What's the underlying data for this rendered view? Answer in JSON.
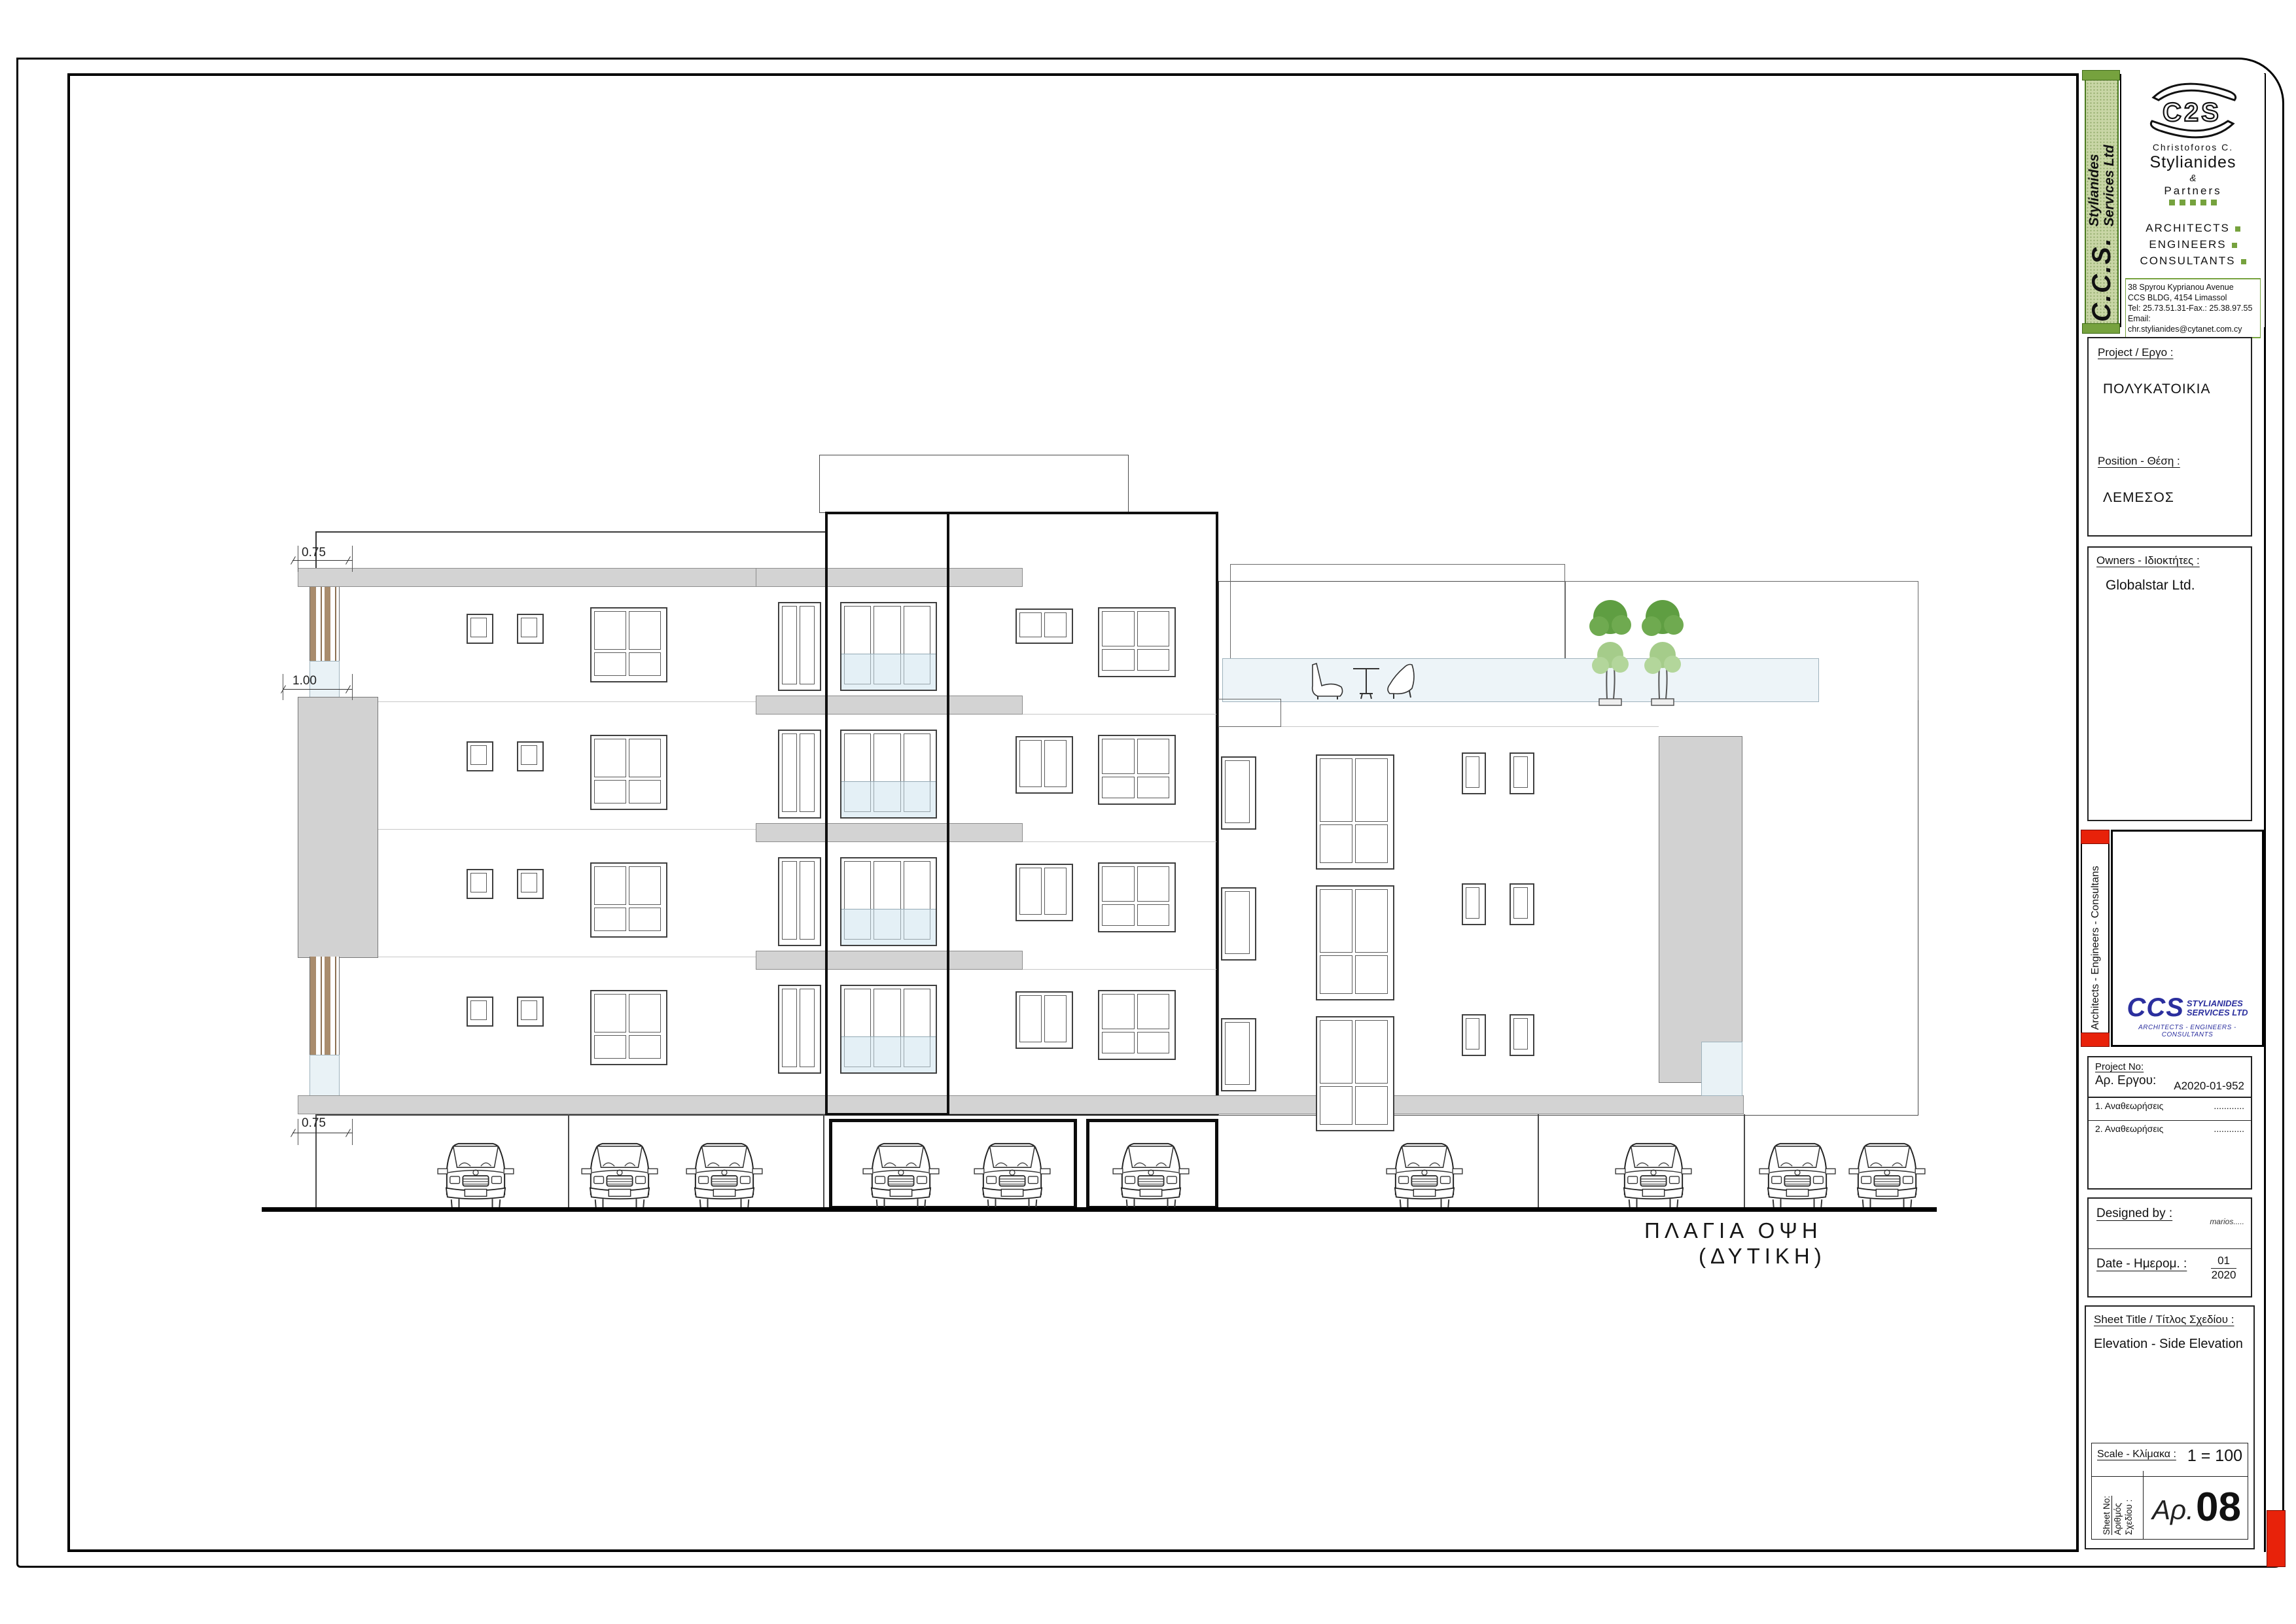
{
  "company": {
    "band_line1": "Stylianides",
    "band_line2": "Services Ltd",
    "band_ccs": "C.C.S.",
    "logo_mark": "C2S",
    "principal_small": "Christoforos  C.",
    "principal_big": "Stylianides",
    "amp": "&",
    "partners": "Partners",
    "role1": "ARCHITECTS",
    "role2": "ENGINEERS",
    "role3": "CONSULTANTS",
    "addr1": "38  Spyrou  Kyprianou  Avenue",
    "addr2": "CCS  BLDG,    4154  Limassol",
    "addr3": "Tel: 25.73.51.31-Fax.:   25.38.97.55",
    "addr4": "Email: chr.stylianides@cytanet.com.cy"
  },
  "project": {
    "label": "Project /  Εργο :",
    "name": "ΠΟΛΥΚΑΤΟΙΚΙΑ",
    "position_label": "Position -  Θέση :",
    "position": "ΛΕΜΕΣΟΣ"
  },
  "owners": {
    "label": "Owners  -  Ιδιοκτήτες :",
    "name": "Globalstar Ltd."
  },
  "side_strip": {
    "text": "Architects  -  Engineers  -  Consultans"
  },
  "firm_logo": {
    "ccs": "CCS",
    "line1": "STYLIANIDES",
    "line2": "SERVICES LTD",
    "sub": "ARCHITECTS - ENGINEERS - CONSULTANTS"
  },
  "project_no": {
    "label1": "Project No:",
    "label2": "Αρ. Εργου:",
    "value": "A2020-01-952",
    "rev1": "1. Αναθεωρήσεις",
    "rev2": "2. Αναθεωρήσεις",
    "dots": "............"
  },
  "designed": {
    "label": "Designed by :",
    "value": "marios.....",
    "date_label": "Date -  Ημερομ. :",
    "month": "01",
    "year": "2020"
  },
  "sheet_title": {
    "label": "Sheet  Title  /   Τίτλος Σχεδίου :",
    "value": "Elevation - Side Elevation"
  },
  "scale": {
    "label": "Scale - Κλίμακα :",
    "value": "1 = 100"
  },
  "sheet_no": {
    "label1": "Sheet No:",
    "label2": "Αριθμός",
    "label3": "Σχεδίου :",
    "prefix": "Αρ.",
    "value": "08"
  },
  "drawing": {
    "dim_top": "0.75",
    "dim_mid": "1.00",
    "dim_bottom": "0.75",
    "view_title_line1": "ΠΛΑΓΙΑ  ΟΨΗ",
    "view_title_line2": "(ΔΥΤΙΚΗ)"
  }
}
